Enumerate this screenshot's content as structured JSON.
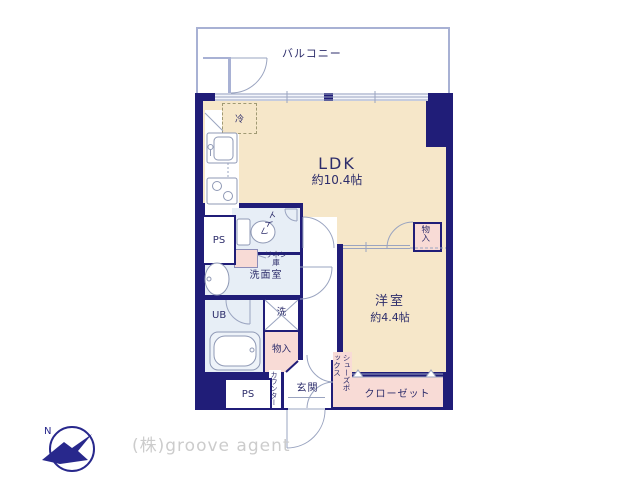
{
  "plan": {
    "balcony": "バルコニー",
    "rooms": {
      "ldk": {
        "name": "LDK",
        "size": "約10.4帖"
      },
      "western_room": {
        "name": "洋室",
        "size": "約4.4帖"
      },
      "entrance": "玄関",
      "washroom": "洗面室",
      "toilet": "トイレ",
      "unit_bath": "UB",
      "closet": "クローゼット",
      "shoes_box": "シューズボックス",
      "storage_right": "物入",
      "storage_lower": "物入",
      "linen": "リネン庫",
      "counter": "カウンター",
      "washer": "洗",
      "fridge": "冷",
      "ps_upper": "PS",
      "ps_lower": "PS"
    }
  },
  "branding": {
    "company": "(株)groove agent",
    "logo_letter": "N"
  },
  "colors": {
    "wall": "#201d78",
    "room_cream": "#f6e7c9",
    "room_blue": "#e7eef6",
    "room_pink": "#f8dbd6",
    "line": "#9aa4c0",
    "logo": "#28288c"
  }
}
